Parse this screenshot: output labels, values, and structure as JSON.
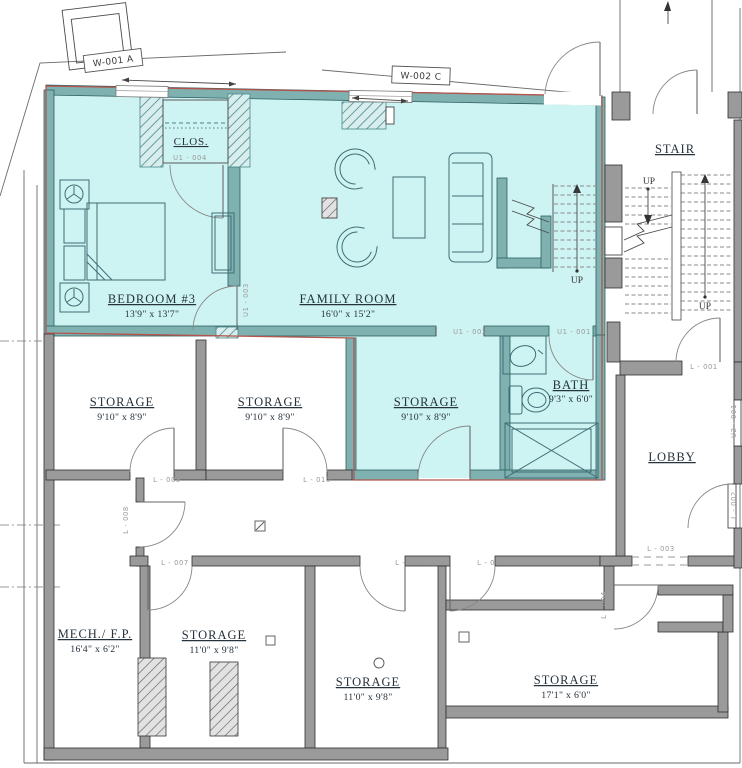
{
  "colors": {
    "highlight": "#cdf4f2",
    "unit_wall": "#7fb1b1",
    "unit_outline": "#b5544c",
    "common_wall": "#9a9a9a"
  },
  "window_tags": {
    "w001": "W-001 A",
    "w002": "W-002 C"
  },
  "rooms": {
    "bedroom3": {
      "name": "BEDROOM #3",
      "dims": "13'9\" x 13'7\""
    },
    "closet": {
      "name": "CLOS."
    },
    "family": {
      "name": "FAMILY ROOM",
      "dims": "16'0\" x 15'2\""
    },
    "bath": {
      "name": "BATH",
      "dims": "9'3\" x 6'0\""
    },
    "stair": {
      "name": "STAIR"
    },
    "lobby": {
      "name": "LOBBY"
    },
    "storage_nw": {
      "name": "STORAGE",
      "dims": "9'10\" x 8'9\""
    },
    "storage_n": {
      "name": "STORAGE",
      "dims": "9'10\" x 8'9\""
    },
    "storage_unit": {
      "name": "STORAGE",
      "dims": "9'10\" x 8'9\""
    },
    "mech": {
      "name": "MECH./ F.P.",
      "dims": "16'4\" x 6'2\""
    },
    "storage_sw": {
      "name": "STORAGE",
      "dims": "11'0\" x 9'8\""
    },
    "storage_s": {
      "name": "STORAGE",
      "dims": "11'0\" x 9'8\""
    },
    "storage_se": {
      "name": "STORAGE",
      "dims": "17'1\" x 6'0\""
    }
  },
  "door_tags": {
    "u1_001": "U1 - 001",
    "u1_002": "U1 - 002",
    "u1_003": "U1 - 003",
    "u1_004": "U1 - 004",
    "u2_001": "U2 - 001",
    "l_001": "L - 001",
    "l_002": "L - 002",
    "l_003": "L - 003",
    "l_004": "L - 004",
    "l_005": "L - 005",
    "l_006": "L - 006",
    "l_007": "L - 007",
    "l_008": "L - 008",
    "l_009": "L - 009",
    "l_010": "L - 010"
  },
  "annotations": {
    "up": "UP"
  }
}
